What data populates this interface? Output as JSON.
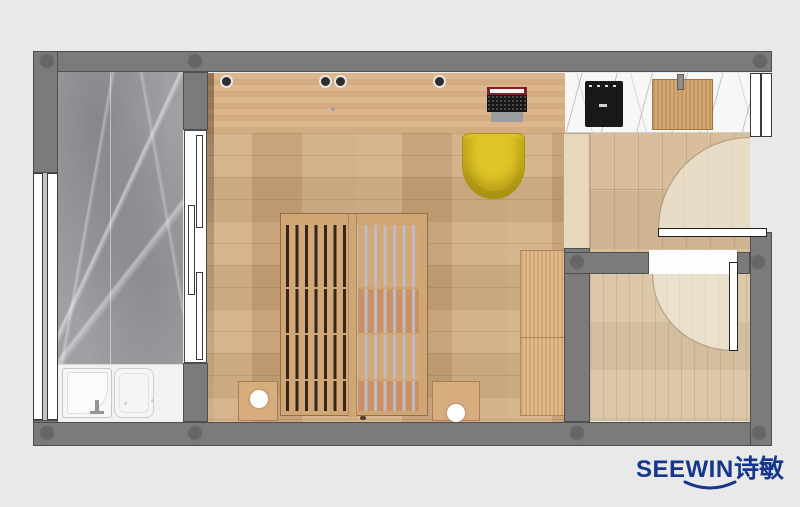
{
  "brand": {
    "name_latin": "SEEWIN",
    "name_cjk": "诗敏",
    "logo_color": "#15368c"
  },
  "palette": {
    "background": "#e9e9e9",
    "wall": "#7b7b7b",
    "wall_outline": "#4f4f4f",
    "bedroom_floor": "#cfa87a",
    "desk_wood": "#dab285",
    "hall_floor": "#d6bb96",
    "small_room_floor": "#dbc5a4",
    "door_swing": "#e8dcc6",
    "marble_floor_gray": "#9fa0a3",
    "kitchen_counter_marble": "#f7f7f6",
    "bed_wood": "#d2a878",
    "bed_slat_gap_dark": "#33261b",
    "bed_slat_gap_light": "#bfbdc3",
    "chair_yellow": "#d6ba1f",
    "cooktop_black": "#191919",
    "bath_fixture_white": "#f5f5f5",
    "cabinet_cream": "#e7d8bd"
  }
}
